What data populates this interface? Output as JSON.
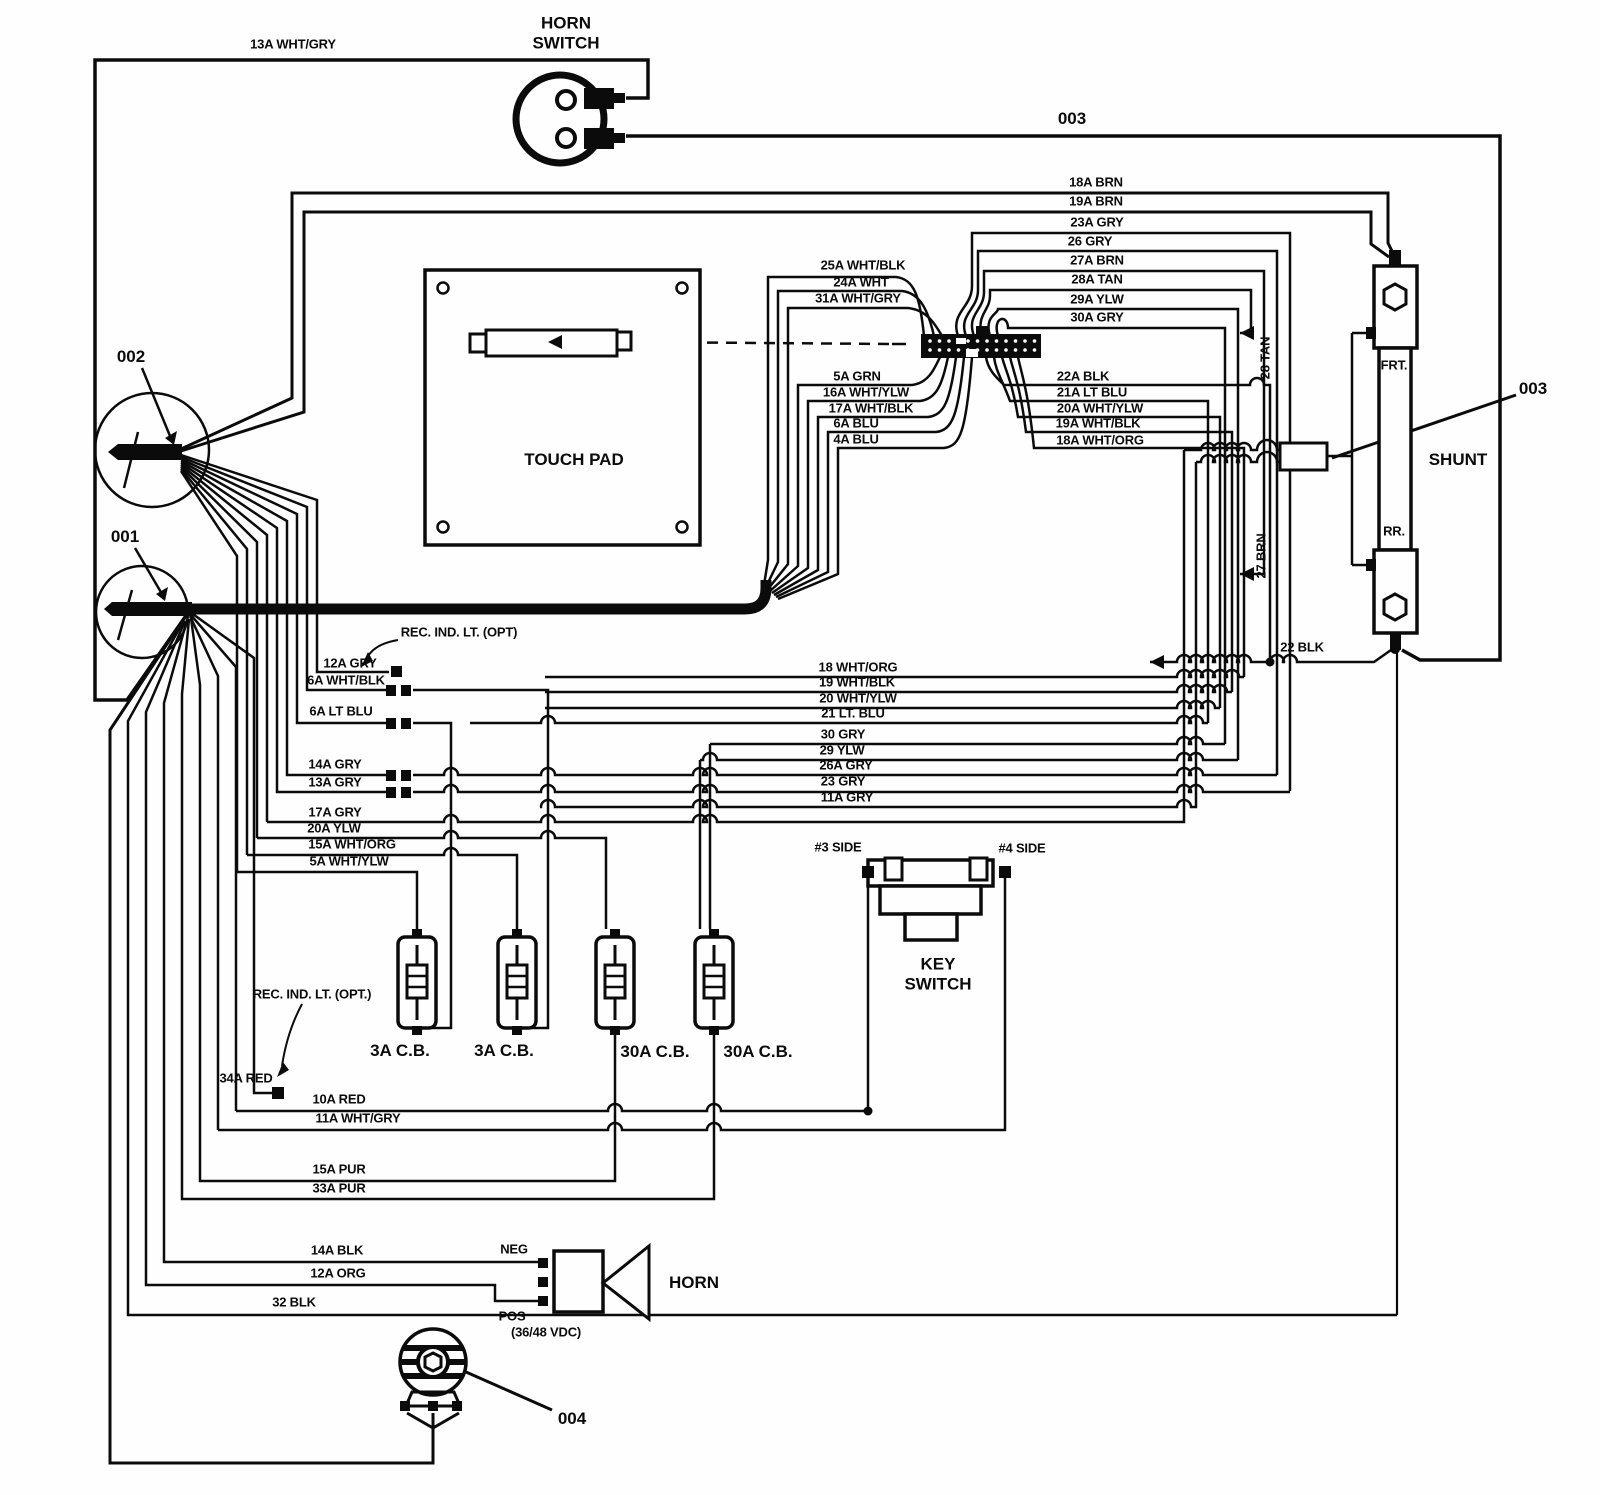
{
  "diagram": {
    "type": "electrical-wiring-diagram",
    "ink": "#0b0b0b",
    "bg": "#fefefe",
    "components": [
      "HORN SWITCH",
      "TOUCH PAD",
      "SHUNT",
      "KEY SWITCH",
      "HORN",
      "3A C.B.",
      "30A C.B."
    ],
    "reference_callouts": [
      "001",
      "002",
      "003",
      "004"
    ]
  },
  "labels": [
    {
      "id": "wire-13a-wht-gry",
      "t": "13A WHT/GRY",
      "x": 293,
      "y": 45
    },
    {
      "id": "horn-switch-title",
      "t": "HORN SWITCH",
      "x": 566,
      "y": 33,
      "c": "big wrap",
      "w": 84
    },
    {
      "id": "ref-003-top",
      "t": "003",
      "x": 1072,
      "y": 119,
      "c": "big"
    },
    {
      "id": "wire-18a-brn",
      "t": "18A BRN",
      "x": 1096,
      "y": 183
    },
    {
      "id": "wire-19a-brn",
      "t": "19A BRN",
      "x": 1096,
      "y": 202
    },
    {
      "id": "wire-23a-gry",
      "t": "23A GRY",
      "x": 1097,
      "y": 223
    },
    {
      "id": "wire-26-gry",
      "t": "26 GRY",
      "x": 1090,
      "y": 242
    },
    {
      "id": "wire-27a-brn",
      "t": "27A BRN",
      "x": 1097,
      "y": 261
    },
    {
      "id": "wire-28a-tan",
      "t": "28A TAN",
      "x": 1097,
      "y": 280
    },
    {
      "id": "wire-29a-ylw",
      "t": "29A YLW",
      "x": 1097,
      "y": 300
    },
    {
      "id": "wire-30a-gry",
      "t": "30A GRY",
      "x": 1097,
      "y": 318
    },
    {
      "id": "wire-25a-wht-blk",
      "t": "25A WHT/BLK",
      "x": 863,
      "y": 266
    },
    {
      "id": "wire-24a-wht",
      "t": "24A WHT",
      "x": 861,
      "y": 283
    },
    {
      "id": "wire-31a-wht-gry",
      "t": "31A WHT/GRY",
      "x": 858,
      "y": 299
    },
    {
      "id": "wire-5a-grn",
      "t": "5A GRN",
      "x": 857,
      "y": 377
    },
    {
      "id": "wire-16a-wht-ylw",
      "t": "16A WHT/YLW",
      "x": 866,
      "y": 393
    },
    {
      "id": "wire-17a-wht-blk",
      "t": "17A WHT/BLK",
      "x": 871,
      "y": 409
    },
    {
      "id": "wire-6a-blu",
      "t": "6A BLU",
      "x": 856,
      "y": 424
    },
    {
      "id": "wire-4a-blu",
      "t": "4A BLU",
      "x": 856,
      "y": 440
    },
    {
      "id": "wire-22a-blk",
      "t": "22A BLK",
      "x": 1083,
      "y": 377
    },
    {
      "id": "wire-21a-lt-blu",
      "t": "21A LT BLU",
      "x": 1092,
      "y": 393
    },
    {
      "id": "wire-20a-wht-ylw",
      "t": "20A WHT/YLW",
      "x": 1100,
      "y": 409
    },
    {
      "id": "wire-19a-wht-blk",
      "t": "19A WHT/BLK",
      "x": 1098,
      "y": 424
    },
    {
      "id": "wire-18a-wht-org",
      "t": "18A WHT/ORG",
      "x": 1100,
      "y": 441
    },
    {
      "id": "touch-pad-title",
      "t": "TOUCH PAD",
      "x": 574,
      "y": 460,
      "c": "big"
    },
    {
      "id": "ref-002",
      "t": "002",
      "x": 131,
      "y": 357,
      "c": "big"
    },
    {
      "id": "ref-001",
      "t": "001",
      "x": 125,
      "y": 537,
      "c": "big"
    },
    {
      "id": "note-rec-ind-lt-top",
      "t": "REC. IND. LT. (OPT)",
      "x": 459,
      "y": 633
    },
    {
      "id": "wire-12a-gry",
      "t": "12A GRY",
      "x": 350,
      "y": 664
    },
    {
      "id": "wire-6a-wht-blk",
      "t": "6A WHT/BLK",
      "x": 346,
      "y": 681
    },
    {
      "id": "wire-6a-lt-blu",
      "t": "6A LT BLU",
      "x": 341,
      "y": 712
    },
    {
      "id": "wire-14a-gry",
      "t": "14A GRY",
      "x": 335,
      "y": 765
    },
    {
      "id": "wire-13a-gry",
      "t": "13A GRY",
      "x": 335,
      "y": 783
    },
    {
      "id": "wire-17a-gry",
      "t": "17A GRY",
      "x": 335,
      "y": 813
    },
    {
      "id": "wire-20a-ylw",
      "t": "20A YLW",
      "x": 334,
      "y": 829
    },
    {
      "id": "wire-15a-wht-org",
      "t": "15A WHT/ORG",
      "x": 352,
      "y": 845
    },
    {
      "id": "wire-5a-wht-ylw",
      "t": "5A WHT/YLW",
      "x": 349,
      "y": 862
    },
    {
      "id": "wire-18-wht-org",
      "t": "18 WHT/ORG",
      "x": 858,
      "y": 668
    },
    {
      "id": "wire-19-wht-blk",
      "t": "19 WHT/BLK",
      "x": 857,
      "y": 683
    },
    {
      "id": "wire-20-wht-ylw",
      "t": "20 WHT/YLW",
      "x": 858,
      "y": 699
    },
    {
      "id": "wire-21-lt-blu",
      "t": "21 LT. BLU",
      "x": 853,
      "y": 714
    },
    {
      "id": "wire-30-gry",
      "t": "30 GRY",
      "x": 843,
      "y": 735
    },
    {
      "id": "wire-29-ylw",
      "t": "29 YLW",
      "x": 842,
      "y": 751
    },
    {
      "id": "wire-26a-gry",
      "t": "26A GRY",
      "x": 846,
      "y": 766
    },
    {
      "id": "wire-23-gry",
      "t": "23 GRY",
      "x": 843,
      "y": 782
    },
    {
      "id": "wire-11a-gry",
      "t": "11A GRY",
      "x": 847,
      "y": 798
    },
    {
      "id": "wire-28-tan",
      "t": "28 TAN",
      "x": 1266,
      "y": 358,
      "c": "v"
    },
    {
      "id": "wire-27-brn",
      "t": "27 BRN",
      "x": 1262,
      "y": 556,
      "c": "v"
    },
    {
      "id": "shunt-frt",
      "t": "FRT.",
      "x": 1394,
      "y": 366
    },
    {
      "id": "shunt-rr",
      "t": "RR.",
      "x": 1394,
      "y": 532
    },
    {
      "id": "shunt-title",
      "t": "SHUNT",
      "x": 1458,
      "y": 460,
      "c": "big"
    },
    {
      "id": "ref-003-right",
      "t": "003",
      "x": 1533,
      "y": 389,
      "c": "big"
    },
    {
      "id": "wire-22-blk",
      "t": "22 BLK",
      "x": 1302,
      "y": 648
    },
    {
      "id": "key-switch-3-side",
      "t": "#3 SIDE",
      "x": 838,
      "y": 848
    },
    {
      "id": "key-switch-4-side",
      "t": "#4 SIDE",
      "x": 1022,
      "y": 849
    },
    {
      "id": "key-switch-title",
      "t": "KEY SWITCH",
      "x": 938,
      "y": 974,
      "c": "big wrap",
      "w": 80
    },
    {
      "id": "cb1-label",
      "t": "3A C.B.",
      "x": 400,
      "y": 1051,
      "c": "big"
    },
    {
      "id": "cb2-label",
      "t": "3A C.B.",
      "x": 504,
      "y": 1051,
      "c": "big"
    },
    {
      "id": "cb3-label",
      "t": "30A C.B.",
      "x": 655,
      "y": 1052,
      "c": "big"
    },
    {
      "id": "cb4-label",
      "t": "30A C.B.",
      "x": 758,
      "y": 1052,
      "c": "big"
    },
    {
      "id": "note-rec-ind-lt-bottom",
      "t": "REC. IND. LT. (OPT.)",
      "x": 312,
      "y": 995
    },
    {
      "id": "wire-34a-red",
      "t": "34A RED",
      "x": 246,
      "y": 1079
    },
    {
      "id": "wire-10a-red",
      "t": "10A RED",
      "x": 339,
      "y": 1100
    },
    {
      "id": "wire-11a-wht-gry",
      "t": "11A WHT/GRY",
      "x": 358,
      "y": 1119
    },
    {
      "id": "wire-15a-pur",
      "t": "15A PUR",
      "x": 339,
      "y": 1170
    },
    {
      "id": "wire-33a-pur",
      "t": "33A PUR",
      "x": 339,
      "y": 1189
    },
    {
      "id": "wire-14a-blk",
      "t": "14A BLK",
      "x": 337,
      "y": 1251
    },
    {
      "id": "wire-12a-org",
      "t": "12A ORG",
      "x": 338,
      "y": 1274
    },
    {
      "id": "horn-neg",
      "t": "NEG",
      "x": 514,
      "y": 1250
    },
    {
      "id": "horn-pos",
      "t": "POS",
      "x": 512,
      "y": 1317
    },
    {
      "id": "horn-voltage",
      "t": "(36/48 VDC)",
      "x": 546,
      "y": 1333
    },
    {
      "id": "horn-title",
      "t": "HORN",
      "x": 694,
      "y": 1283,
      "c": "big"
    },
    {
      "id": "wire-32-blk",
      "t": "32 BLK",
      "x": 294,
      "y": 1303
    },
    {
      "id": "ref-004",
      "t": "004",
      "x": 572,
      "y": 1419,
      "c": "big"
    }
  ]
}
